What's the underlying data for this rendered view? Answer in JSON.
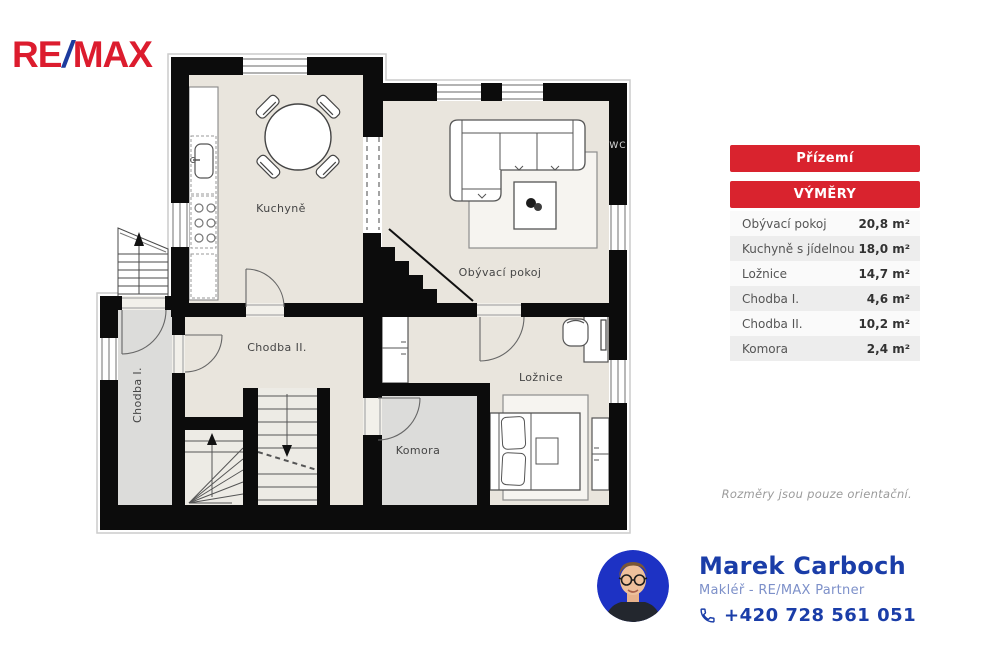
{
  "brand": {
    "part1": "RE",
    "slash": "/",
    "part2": "MAX"
  },
  "plan": {
    "rooms": [
      {
        "id": "kuchyne",
        "label": "Kuchyně"
      },
      {
        "id": "obyvaci-pokoj",
        "label": "Obývací pokoj"
      },
      {
        "id": "chodba-2",
        "label": "Chodba II."
      },
      {
        "id": "chodba-1",
        "label": "Chodba I."
      },
      {
        "id": "komora",
        "label": "Komora"
      },
      {
        "id": "loznice",
        "label": "Ložnice"
      },
      {
        "id": "wc",
        "label": "WC"
      }
    ],
    "disclaimer": "Rozměry jsou pouze orientační."
  },
  "panel": {
    "floor_label": "Přízemí",
    "areas_label": "VÝMĚRY",
    "accent_color": "#d9232e",
    "rows": [
      {
        "name": "Obývací pokoj",
        "area": "20,8 m²"
      },
      {
        "name": "Kuchyně s jídelnou",
        "area": "18,0 m²"
      },
      {
        "name": "Ložnice",
        "area": "14,7 m²"
      },
      {
        "name": "Chodba I.",
        "area": "4,6 m²"
      },
      {
        "name": "Chodba II.",
        "area": "10,2 m²"
      },
      {
        "name": "Komora",
        "area": "2,4 m²"
      }
    ]
  },
  "agent": {
    "name": "Marek Carboch",
    "role": "Makléř - RE/MAX Partner",
    "phone": "+420 728 561 051"
  }
}
